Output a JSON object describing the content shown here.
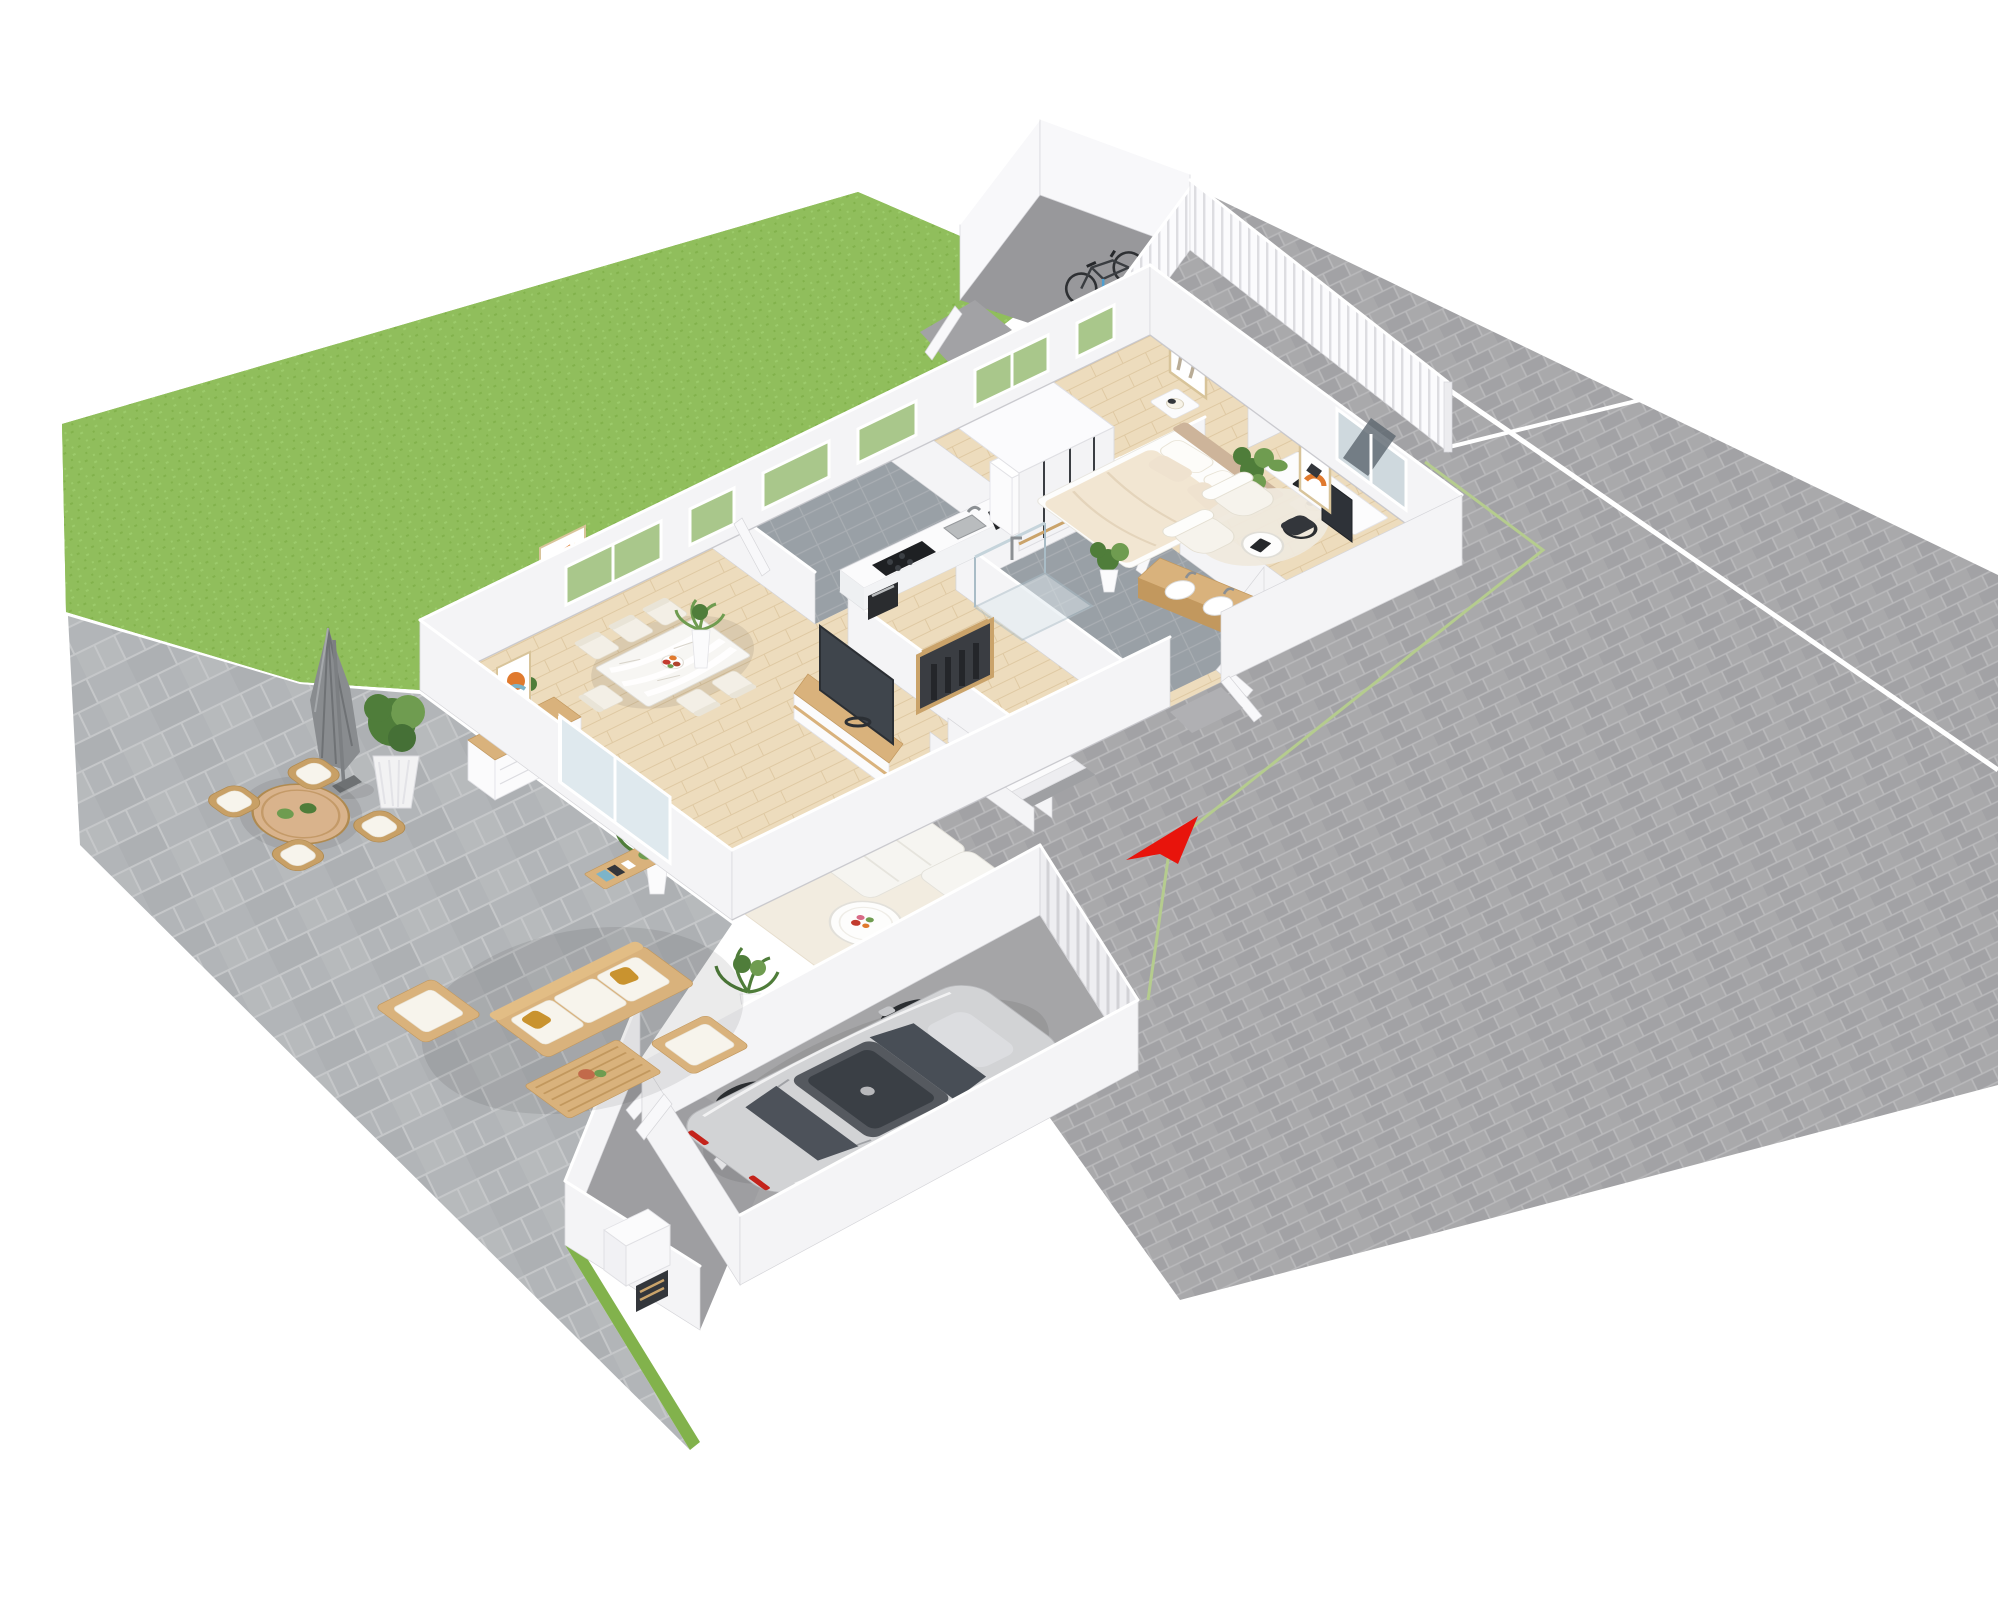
{
  "image": {
    "kind": "3d-floor-plan-render",
    "view": "isometric birds-eye cutaway of a single-storey house with garden, patio, driveway and garage",
    "background": "#ffffff"
  },
  "colors": {
    "grass": "#90be5c",
    "grassDark": "#82b24c",
    "grassLight": "#9ccb6b",
    "paver": "#a9a9ab",
    "paverJoint": "#b9b9bb",
    "paverDark": "#9c9c9f",
    "patio": "#b2b5b8",
    "patioJoint": "#c5c7c9",
    "concretePen": "#98989b",
    "concreteGarage": "#a5a5a7",
    "concretePorch": "#9e9ea1",
    "tile": "#99a0a6",
    "tileJoint": "#a9aeb3",
    "wood": "#eddcbd",
    "woodJoint": "#dfc9a3",
    "wallFace": "#f4f4f6",
    "wallTop": "#ffffff",
    "wallShade": "#e7e7ea",
    "wallEdge": "#d6d6da",
    "glassGreen": "#a9c78b",
    "glassDark": "#5b656e",
    "glassLight": "#dfe9ee",
    "cream": "#f3efe6",
    "whiteFurn": "#fbfbfc",
    "woodFurn": "#d9b27c",
    "woodDark": "#c2985e",
    "wicker": "#c8a066",
    "cushion": "#f7f4ec",
    "mustard": "#c9932f",
    "plant": "#4f7d3a",
    "plantLight": "#6f9c50",
    "carSilver": "#d2d3d5",
    "carGlass": "#484e56",
    "wheel": "#2b2e31",
    "accentRed": "#e8140c",
    "dark": "#33363b",
    "tv": "#3f454c",
    "appliance": "#222427",
    "rug": "#f2ece0"
  },
  "scene": {
    "exterior": [
      {
        "name": "lawn-strip",
        "surface": "grass"
      },
      {
        "name": "driveway-and-plaza",
        "surface": "grey brick pavers",
        "details": [
          "white parcel seam lines",
          "thin green boundary line"
        ]
      },
      {
        "name": "patio",
        "surface": "large grey stone tiles",
        "furniture": [
          "closed parasol",
          "potted shrub",
          "round wicker table with two small plants",
          "four wicker chairs",
          "wooden lounge sofa with white cushions and mustard pillows",
          "wooden armchair",
          "wooden slat coffee table",
          "wooden ottoman"
        ]
      },
      {
        "name": "bike-enclosure",
        "surface": "concrete",
        "details": [
          "white walls",
          "white slatted fence",
          "gate ajar",
          "bicycle"
        ]
      },
      {
        "name": "boundary-fence",
        "details": [
          "white vertical slats running along the north-east side"
        ]
      }
    ],
    "rooms": [
      {
        "name": "living-dining-room",
        "floor": "light wood planks",
        "furniture": [
          "white sideboard with wood top and plant",
          "framed abstract art",
          "dining table with white cloth and flower bowl",
          "six cream chairs",
          "tall planter",
          "tv lowboard",
          "flat tv",
          "cream rug",
          "white l-shaped sofa",
          "round white coffee table with flowers",
          "potted palms",
          "wooden console with books"
        ]
      },
      {
        "name": "kitchen",
        "floor": "grey tile",
        "furniture": [
          "white counter block",
          "black cooktop",
          "built-in oven",
          "sink with faucet",
          "black coffee machine",
          "tall white cabinet column"
        ]
      },
      {
        "name": "bedroom",
        "floor": "light wood planks",
        "furniture": [
          "white sliding wardrobe",
          "double bed with beige duvet",
          "two nightstands with lamps",
          "framed wavy art",
          "fiddle-leaf plant"
        ]
      },
      {
        "name": "office",
        "floor": "light wood planks",
        "furniture": [
          "two cream armchairs",
          "round side table with laptop",
          "round cream rug",
          "white desk with monitor",
          "black office chair",
          "framed orange art",
          "window with dark reflection"
        ]
      },
      {
        "name": "bathroom",
        "floor": "grey tile",
        "furniture": [
          "wood double-sink vanity",
          "glass shower",
          "potted plant",
          "door on canted wall"
        ]
      },
      {
        "name": "hallway",
        "floor": "light wood planks",
        "furniture": [
          "coat niche with dark coats",
          "staircase to basement",
          "front door ajar"
        ]
      },
      {
        "name": "entry-porch",
        "floor": "concrete",
        "furniture": [
          "two doors ajar",
          "white utility cabinet",
          "wooden shoe rack"
        ]
      },
      {
        "name": "garage",
        "floor": "concrete",
        "furniture": [
          "slatted garage door",
          "side door"
        ]
      }
    ],
    "vehicles": [
      {
        "name": "car",
        "type": "silver hatchback",
        "location": "garage",
        "heading": "north-east"
      },
      {
        "name": "bicycle",
        "location": "bike-enclosure"
      }
    ],
    "markers": [
      {
        "name": "entrance-arrow",
        "color": "#e8140c",
        "meaning": "main entrance",
        "points": "toward front door on the south-east side"
      }
    ]
  }
}
